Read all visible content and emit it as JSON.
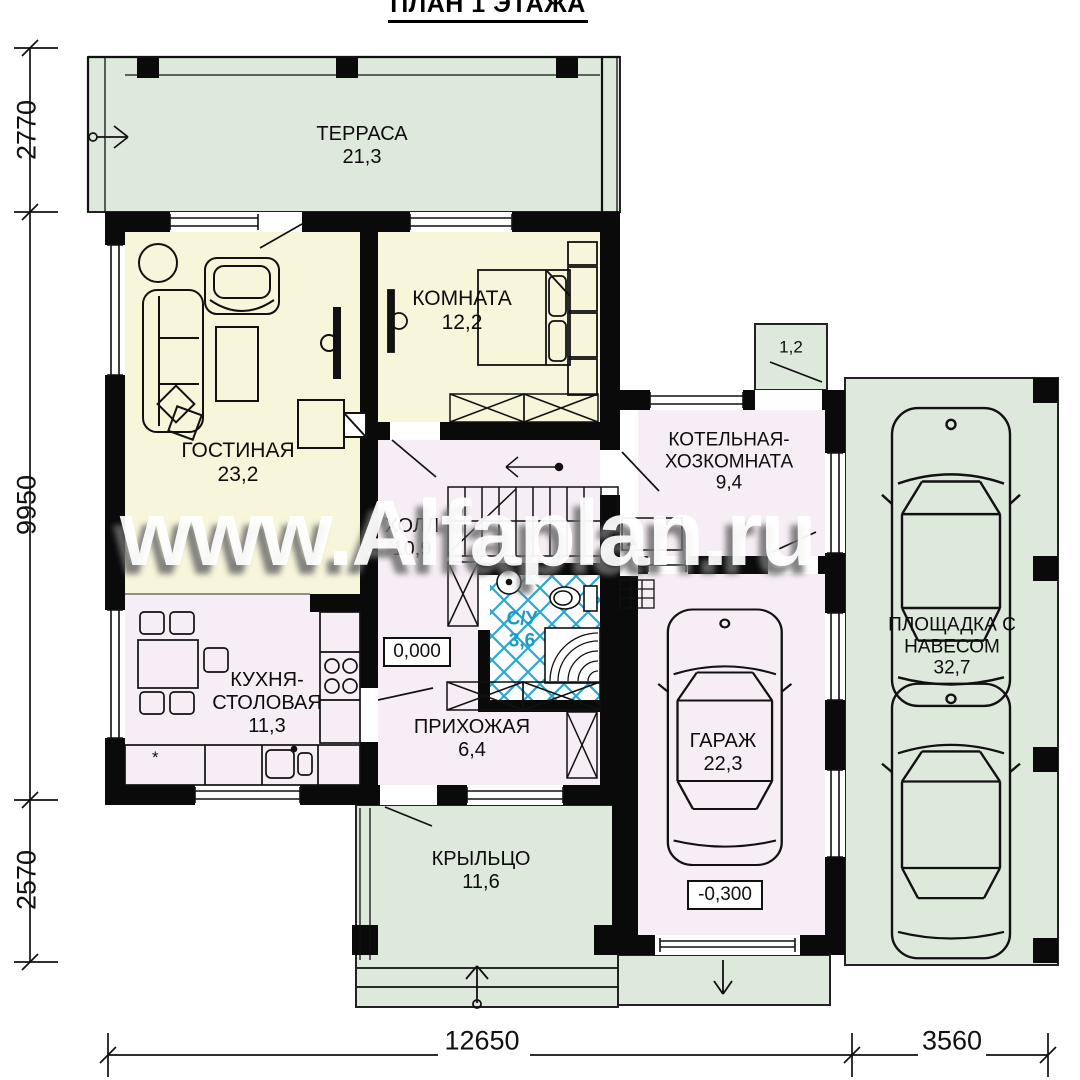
{
  "title": "ПЛАН 1 ЭТАЖА",
  "watermark": "www.Alfaplan.ru",
  "rooms": {
    "terrace": {
      "name": "ТЕРРАСА",
      "area": "21,3"
    },
    "living": {
      "name": "ГОСТИНАЯ",
      "area": "23,2"
    },
    "bedroom": {
      "name": "КОМНАТА",
      "area": "12,2"
    },
    "hall": {
      "name": "ХОЛЛ",
      "area": "10,9"
    },
    "bathroom": {
      "name": "С/У",
      "area": "3,6"
    },
    "kitchen": {
      "name": "КУХНЯ-СТОЛОВАЯ",
      "area": "11,3"
    },
    "entry": {
      "name": "ПРИХОЖАЯ",
      "area": "6,4"
    },
    "porch": {
      "name": "КРЫЛЬЦО",
      "area": "11,6"
    },
    "boiler": {
      "name": "КОТЕЛЬНАЯ-ХОЗКОМНАТА",
      "area": "9,4"
    },
    "garage": {
      "name": "ГАРАЖ",
      "area": "22,3"
    },
    "carport": {
      "name": "ПЛОЩАДКА С НАВЕСОМ",
      "area": "32,7"
    },
    "stoop": {
      "area": "1,2"
    }
  },
  "elevations": {
    "ground_floor": "0,000",
    "garage": "-0,300"
  },
  "dimensions": {
    "left_top": "2770",
    "left_middle": "9950",
    "left_bottom": "2570",
    "bottom_main": "12650",
    "bottom_carport": "3560"
  },
  "symbols": {
    "kitchen_appliance": "*"
  },
  "colors": {
    "outdoor_green": "#dde9db",
    "room_yellow": "#f7f5da",
    "room_pink": "#f7eef5",
    "tile_blue": "#2aa7cf",
    "bath_text_blue": "#1a9bc6",
    "wall_black": "#0a0a0a"
  }
}
